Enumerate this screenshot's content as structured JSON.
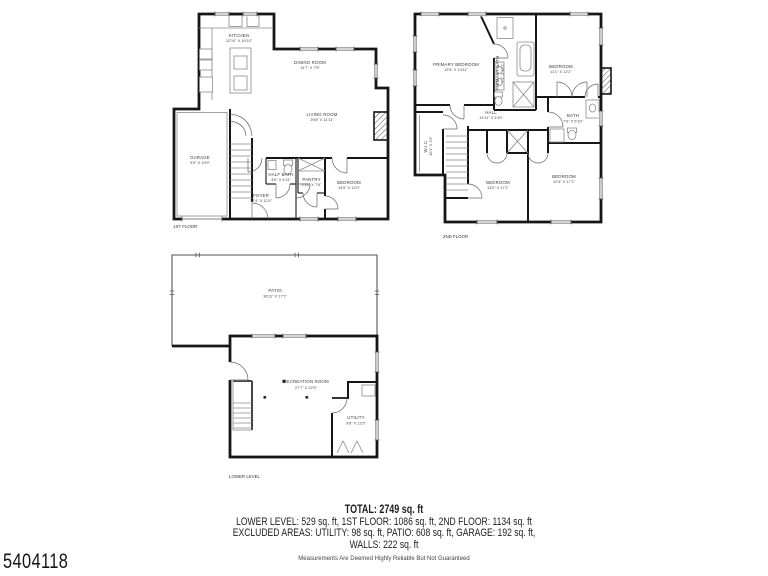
{
  "page": {
    "background": "#ffffff",
    "mls_number": "5404118",
    "disclaimer": "Measurements Are Deemed Highly Reliable But Not Guaranteed"
  },
  "summary": {
    "total": "TOTAL: 2749 sq. ft",
    "line1": "LOWER LEVEL: 529 sq. ft, 1ST FLOOR: 1086 sq. ft, 2ND FLOOR: 1134 sq. ft",
    "line2": "EXCLUDED AREAS: UTILITY: 98 sq. ft, PATIO: 608 sq. ft, GARAGE: 192 sq. ft,",
    "line3": "WALLS: 222 sq. ft"
  },
  "colors": {
    "wall": "#161616",
    "label_text": "#3a3a3a",
    "fixture_line": "#8a8a8a"
  },
  "floors": {
    "first": {
      "label": "1ST FLOOR",
      "rooms": {
        "kitchen": {
          "name": "KITCHEN",
          "dims": "12'10\" X 16'10\""
        },
        "dining": {
          "name": "DINING ROOM",
          "dims": "14'7\" X 7'5\""
        },
        "living": {
          "name": "LIVING ROOM",
          "dims": "29'8\" X 11'11\""
        },
        "garage": {
          "name": "GARAGE",
          "dims": "9'9\" X 19'9\""
        },
        "half_bath": {
          "name": "HALF BATH",
          "dims": "4'6\" X 4'11\""
        },
        "pantry": {
          "name": "PANTRY",
          "dims": "2'10\" X 7'6\""
        },
        "bedroom": {
          "name": "BEDROOM",
          "dims": "14'6\" X 12'0\""
        },
        "foyer": {
          "name": "FOYER",
          "dims": "12'4\" X 12'4\""
        }
      }
    },
    "second": {
      "label": "2ND FLOOR",
      "rooms": {
        "primary_bedroom": {
          "name": "PRIMARY BEDROOM",
          "dims": "13'9\" X 14'11\""
        },
        "primary_bath": {
          "name": "PRIMARY BATH",
          "dims": "7'1\" X 12'2\""
        },
        "bedroom_tr": {
          "name": "BEDROOM",
          "dims": "11'1\" X 12'2\""
        },
        "hall": {
          "name": "HALL",
          "dims": "13'11\" X 3'10\""
        },
        "bath": {
          "name": "BATH",
          "dims": "7'9\" X 5'10\""
        },
        "wic": {
          "name": "W.I.C.",
          "dims": "10'4\" X 3'4\""
        },
        "bedroom_bl": {
          "name": "BEDROOM",
          "dims": "13'0\" X 17'1\""
        },
        "bedroom_br": {
          "name": "BEDROOM",
          "dims": "12'4\" X 17'1\""
        }
      }
    },
    "lower": {
      "label": "LOWER LEVEL",
      "rooms": {
        "patio": {
          "name": "PATIO",
          "dims": "36'11\" X 17'1\""
        },
        "recreation": {
          "name": "RECREATION ROOM",
          "dims": "27'7\" X 22'0\""
        },
        "utility": {
          "name": "UTILITY",
          "dims": "9'8\" X 12'3\""
        }
      }
    }
  }
}
